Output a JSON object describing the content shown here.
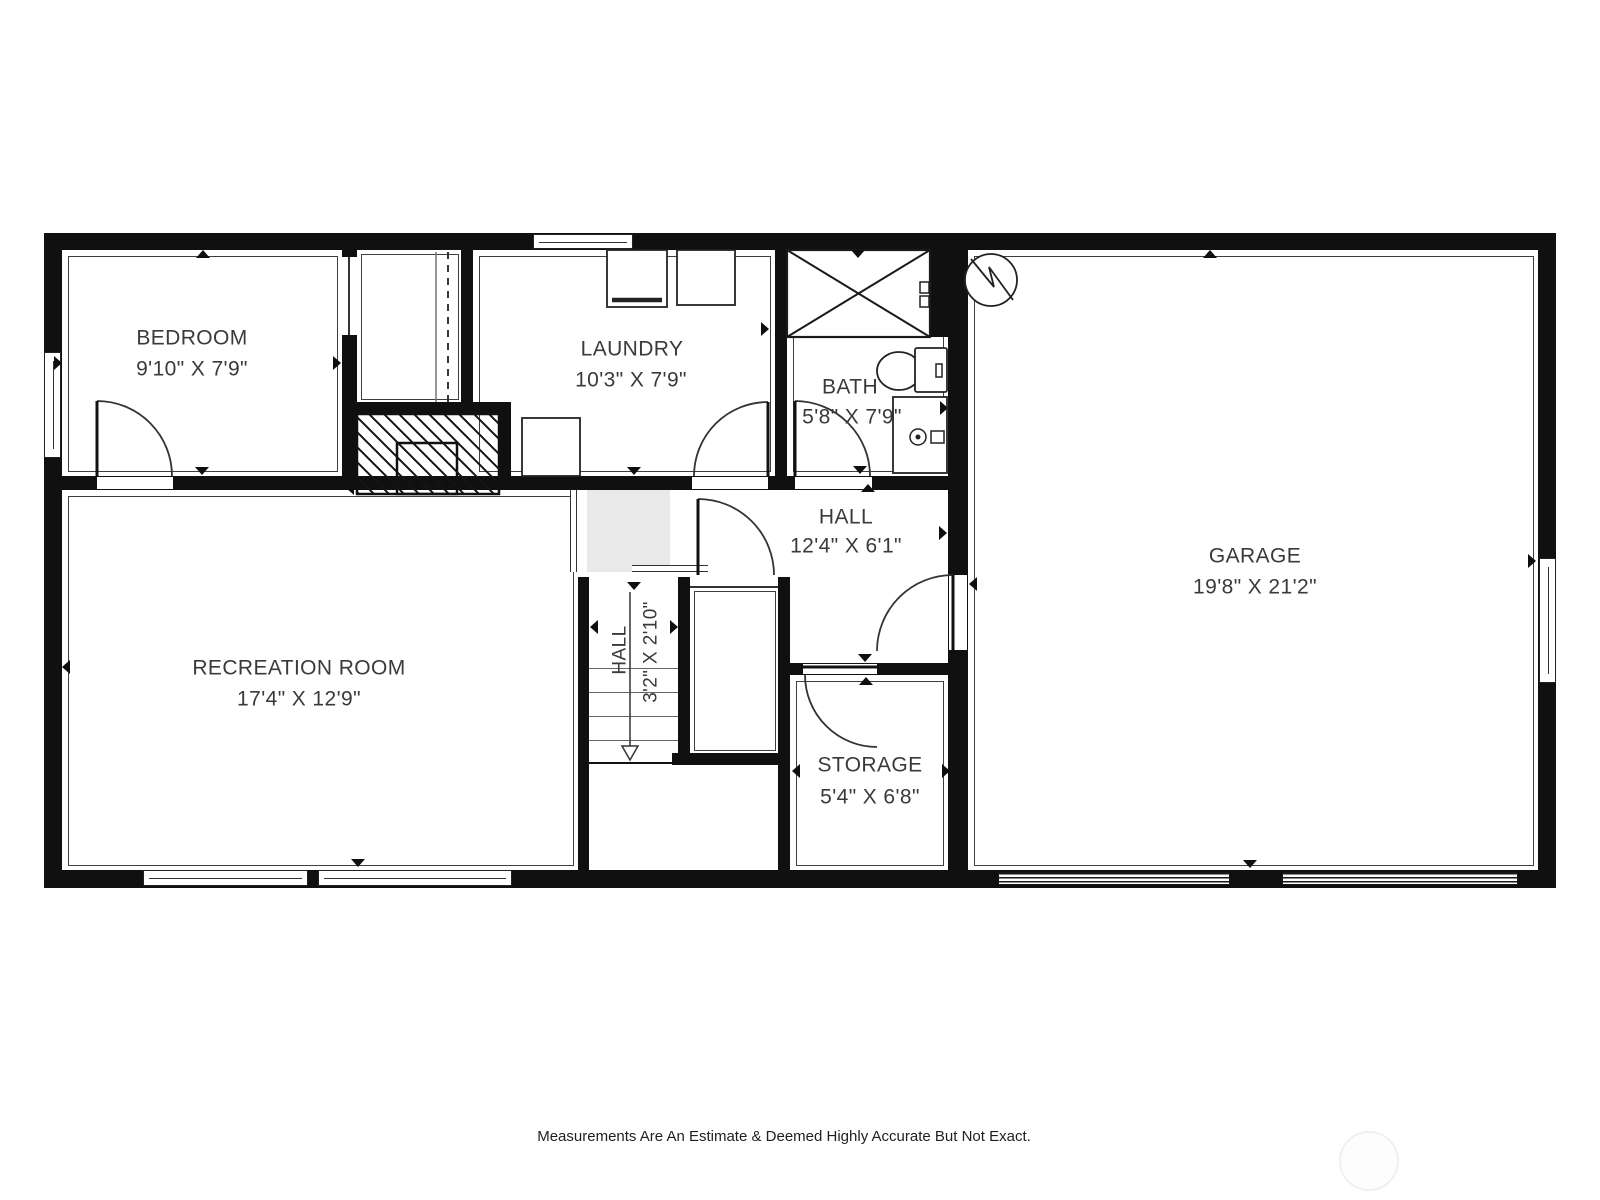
{
  "plan": {
    "rooms": [
      {
        "name": "BEDROOM",
        "dims": "9'10\" X 7'9\""
      },
      {
        "name": "LAUNDRY",
        "dims": "10'3\" X 7'9\""
      },
      {
        "name": "BATH",
        "dims": "5'8\" X 7'9\""
      },
      {
        "name": "HALL",
        "dims": "12'4\" X 6'1\""
      },
      {
        "name": "GARAGE",
        "dims": "19'8\" X 21'2\""
      },
      {
        "name": "RECREATION ROOM",
        "dims": "17'4\" X 12'9\""
      },
      {
        "name": "STORAGE",
        "dims": "5'4\" X 6'8\""
      },
      {
        "name": "HALL",
        "dims": "3'2\" X 2'10\""
      }
    ],
    "footer": "Measurements Are An Estimate & Deemed Highly Accurate But Not Exact.",
    "colors": {
      "wall": "#101010",
      "label": "#3a3a3a",
      "landing": "#e9e9e9"
    }
  }
}
